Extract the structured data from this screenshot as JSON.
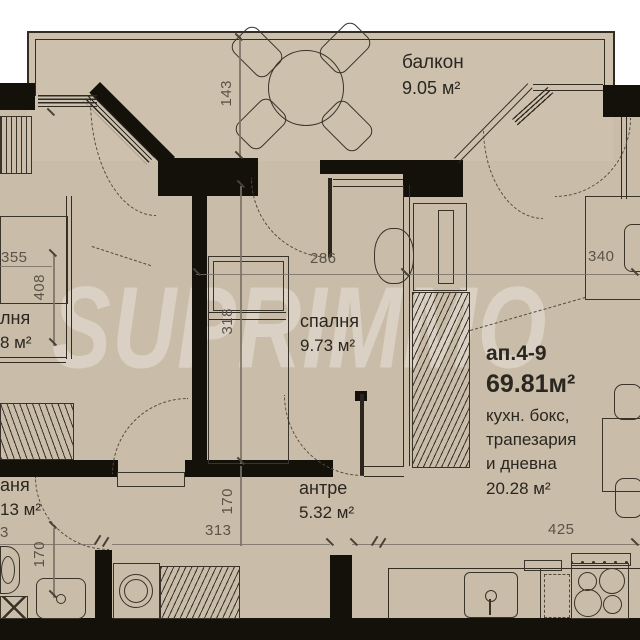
{
  "watermark": "SUPRIMMO",
  "colors": {
    "floor": "#c9bca8",
    "balcony_floor": "#cdc1ae",
    "wall": "#14110b",
    "line": "#3a332a",
    "dim_text": "#5b5349",
    "label_text": "#2a2620",
    "background": "#ffffff"
  },
  "rooms": {
    "balcony": {
      "name": "балкон",
      "area": "9.05 м²"
    },
    "bedroom": {
      "name": "спалня",
      "area": "9.73 м²"
    },
    "hallway": {
      "name": "антре",
      "area": "5.32 м²"
    },
    "left_room_fragment": {
      "name": "лня",
      "area": "8 м²"
    },
    "bathroom_fragment": {
      "name": "аня",
      "area": "13 м²"
    },
    "apartment": {
      "id": "ап.4-9",
      "total_area": "69.81м²",
      "kitchen_line1": "кухн. бокс,",
      "kitchen_line2": "трапезария",
      "kitchen_line3": "и дневна",
      "kitchen_area": "20.28 м²"
    }
  },
  "dimensions": {
    "d143": "143",
    "d355": "355",
    "d408": "408",
    "d286": "286",
    "d318": "318",
    "d340": "340",
    "d313": "313",
    "d170a": "170",
    "d170b": "170",
    "d425": "425",
    "d3": "3"
  }
}
